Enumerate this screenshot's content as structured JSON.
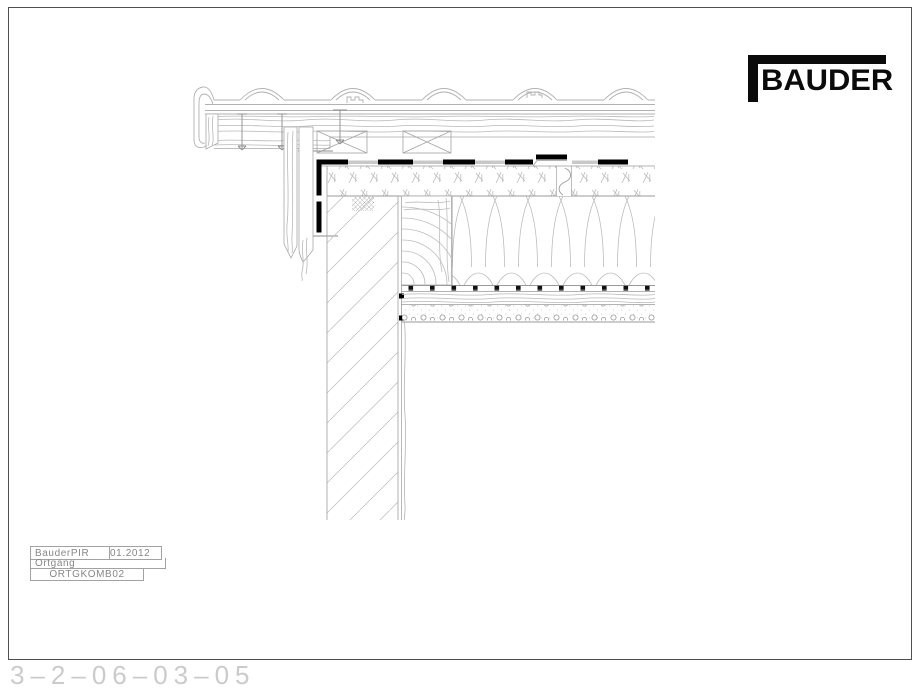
{
  "page": {
    "background": "#ffffff",
    "border_color": "#4f4f4f",
    "footer_number": "3–2–06–03–05"
  },
  "logo": {
    "text": "BAUDER",
    "color": "#0b0b0b"
  },
  "title_block": {
    "product": "BauderPIR",
    "date": "01.2012",
    "drawing_title": "Ortgang",
    "drawing_code": "ORTGKOMB02"
  },
  "drawing": {
    "hairline_color": "#b0b0b0",
    "accent_color": "#000000"
  }
}
